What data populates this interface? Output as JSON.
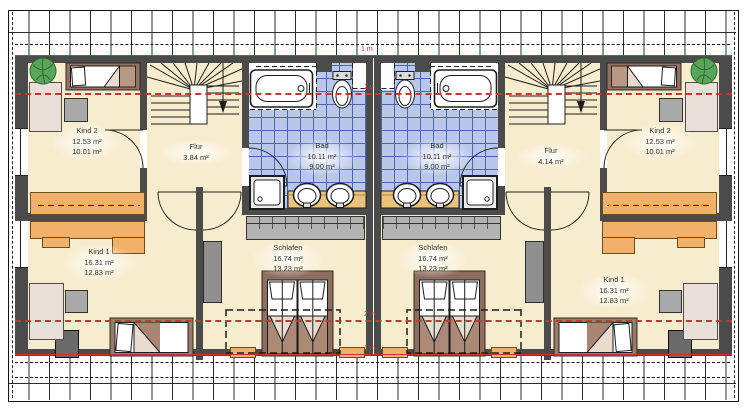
{
  "drawing": {
    "type": "floor-plan",
    "height_lines": {
      "top_1m": "1 m",
      "top_2m": "2 m",
      "bottom_2m": "2 m",
      "bottom_1m": "1 m"
    }
  },
  "units": [
    {
      "side": "left",
      "rooms": {
        "kind2": {
          "name": "Kind 2",
          "areas": [
            "12.53 m²",
            "10.01 m²"
          ]
        },
        "kind1": {
          "name": "Kind 1",
          "areas": [
            "16.31 m²",
            "12.83 m²"
          ]
        },
        "flur": {
          "name": "Flur",
          "areas": [
            "3.84 m²"
          ]
        },
        "bad": {
          "name": "Bad",
          "areas": [
            "10.11 m²",
            "9.00 m²"
          ]
        },
        "schlafen": {
          "name": "Schlafen",
          "areas": [
            "16.74 m²",
            "13.23 m²"
          ]
        }
      }
    },
    {
      "side": "right",
      "rooms": {
        "kind2": {
          "name": "Kind 2",
          "areas": [
            "12.53 m²",
            "10.01 m²"
          ]
        },
        "kind1": {
          "name": "Kind 1",
          "areas": [
            "16.31 m²",
            "12.83 m²"
          ]
        },
        "flur": {
          "name": "Flur",
          "areas": [
            "4.14 m²"
          ]
        },
        "bad": {
          "name": "Bad",
          "areas": [
            "10.11 m²",
            "9.00 m²"
          ]
        },
        "schlafen": {
          "name": "Schlafen",
          "areas": [
            "16.74 m²",
            "13.23 m²"
          ]
        }
      }
    }
  ],
  "colors": {
    "wall": "#4b4b4b",
    "floor": "#f8ecce",
    "tile": "#b7c6e9",
    "tileline": "#5166ae",
    "red": "#c63434",
    "desk": "#f0b26a",
    "dresser": "#eadfd8",
    "grayfurn": "#a9a9a9",
    "closet": "#b3b3b3",
    "bedframe": "#8f7263",
    "plant": "#5aa55c"
  }
}
